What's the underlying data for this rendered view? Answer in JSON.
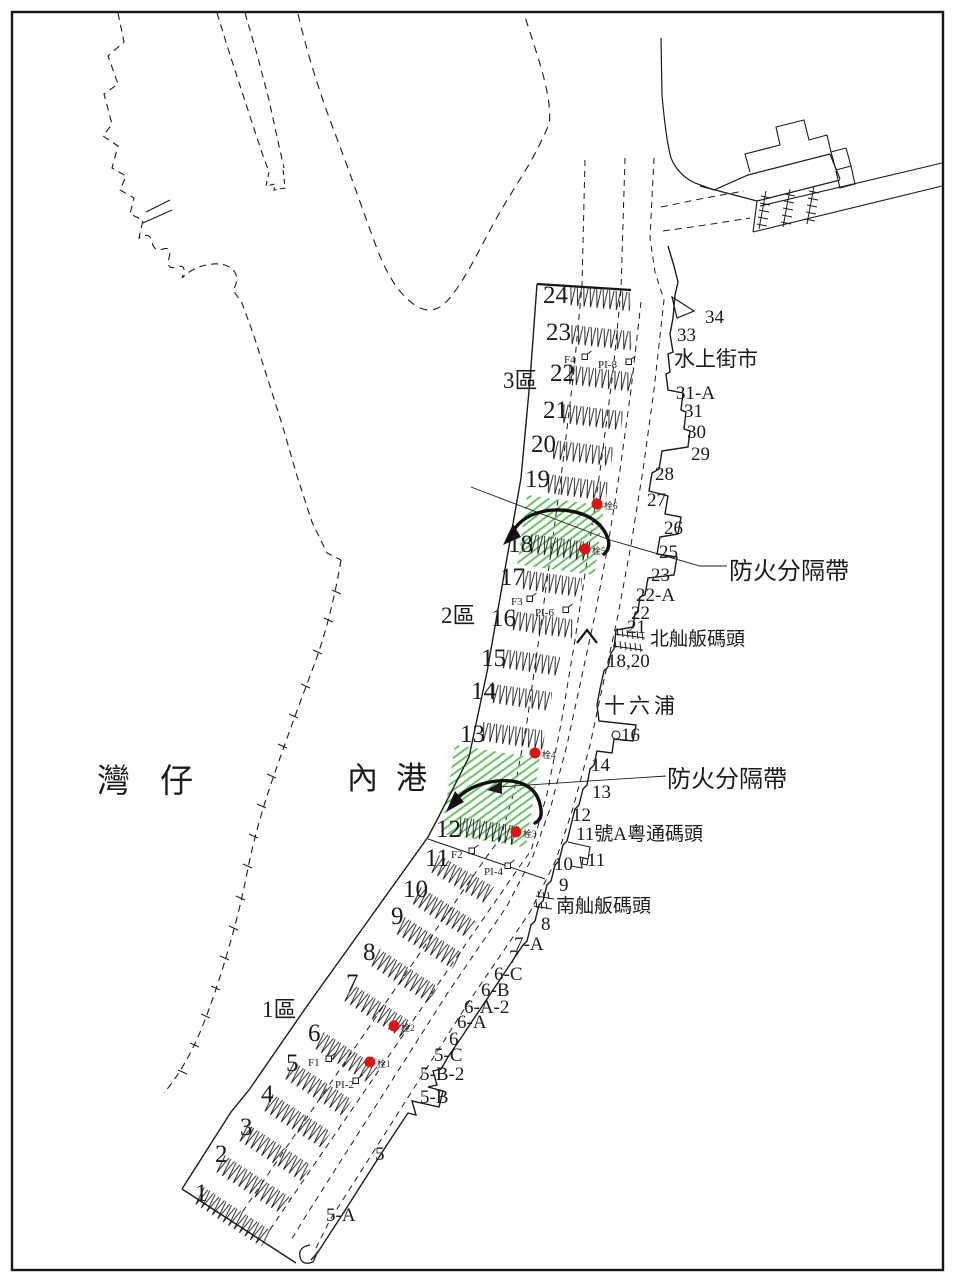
{
  "colors": {
    "ink": "#1c1c1c",
    "green_hatch": "#5cbf5c",
    "red_dot": "#dd1414",
    "red_text": "#e8504a"
  },
  "map": {
    "district_labels": [
      {
        "text": "灣仔",
        "x": 97,
        "y": 792,
        "size": 33,
        "ls": 30
      },
      {
        "text": "內港",
        "x": 347,
        "y": 789,
        "size": 31,
        "ls": 18
      }
    ],
    "zone_labels": [
      {
        "text": "3區",
        "x": 503,
        "y": 388
      },
      {
        "text": "2區",
        "x": 441,
        "y": 623
      },
      {
        "text": "1區",
        "x": 262,
        "y": 1017
      }
    ],
    "firebreak_labels": [
      {
        "text": "防火分隔帶",
        "x": 729,
        "y": 579
      },
      {
        "text": "防火分隔帶",
        "x": 667,
        "y": 787
      }
    ],
    "shore_place_labels": [
      {
        "text": "水上街市",
        "x": 674,
        "y": 366,
        "size": 21
      },
      {
        "text": "北舢舨碼頭",
        "x": 650,
        "y": 645,
        "size": 19
      },
      {
        "text": "十六浦",
        "x": 604,
        "y": 713,
        "size": 21,
        "ls": 4
      },
      {
        "text": "11號A粵通碼頭",
        "x": 576,
        "y": 840,
        "size": 19
      },
      {
        "text": "南舢舨碼頭",
        "x": 556,
        "y": 912,
        "size": 19
      }
    ],
    "berth_labels": [
      {
        "text": "34",
        "x": 705,
        "y": 323
      },
      {
        "text": "33",
        "x": 677,
        "y": 341
      },
      {
        "text": "31-A",
        "x": 676,
        "y": 399
      },
      {
        "text": "31",
        "x": 684,
        "y": 417
      },
      {
        "text": "30",
        "x": 687,
        "y": 438
      },
      {
        "text": "29",
        "x": 691,
        "y": 460
      },
      {
        "text": "28",
        "x": 655,
        "y": 480
      },
      {
        "text": "27",
        "x": 647,
        "y": 506
      },
      {
        "text": "26",
        "x": 664,
        "y": 534
      },
      {
        "text": "25",
        "x": 659,
        "y": 558
      },
      {
        "text": "23",
        "x": 651,
        "y": 581
      },
      {
        "text": "22-A",
        "x": 636,
        "y": 601
      },
      {
        "text": "22",
        "x": 631,
        "y": 619
      },
      {
        "text": "21",
        "x": 627,
        "y": 633
      },
      {
        "text": "18,20",
        "x": 607,
        "y": 667
      },
      {
        "text": "16",
        "x": 621,
        "y": 741
      },
      {
        "text": "14",
        "x": 591,
        "y": 771
      },
      {
        "text": "13",
        "x": 592,
        "y": 798
      },
      {
        "text": "12",
        "x": 572,
        "y": 821
      },
      {
        "text": "11",
        "x": 587,
        "y": 866
      },
      {
        "text": "10",
        "x": 554,
        "y": 870
      },
      {
        "text": "9",
        "x": 559,
        "y": 891
      },
      {
        "text": "8",
        "x": 541,
        "y": 930
      },
      {
        "text": "7-A",
        "x": 514,
        "y": 950
      },
      {
        "text": "7",
        "x": 509,
        "y": 963
      },
      {
        "text": "6-C",
        "x": 494,
        "y": 980
      },
      {
        "text": "6-B",
        "x": 481,
        "y": 996
      },
      {
        "text": "6-A-2",
        "x": 464,
        "y": 1013
      },
      {
        "text": "6-A",
        "x": 457,
        "y": 1028
      },
      {
        "text": "6",
        "x": 449,
        "y": 1045
      },
      {
        "text": "5-C",
        "x": 434,
        "y": 1061
      },
      {
        "text": "5-B-2",
        "x": 420,
        "y": 1080
      },
      {
        "text": "5-B",
        "x": 420,
        "y": 1103
      },
      {
        "text": "5",
        "x": 375,
        "y": 1160
      },
      {
        "text": "5-A",
        "x": 326,
        "y": 1221
      }
    ],
    "mooring_rows": [
      {
        "no": "24",
        "label_x": 543,
        "label_y": 303,
        "x": 570,
        "y": 285,
        "len": 62,
        "angle": 6
      },
      {
        "no": "23",
        "label_x": 546,
        "label_y": 340,
        "x": 571,
        "y": 324,
        "len": 62,
        "angle": 6
      },
      {
        "no": "22",
        "label_x": 550,
        "label_y": 381,
        "x": 569,
        "y": 364,
        "len": 65,
        "angle": 7
      },
      {
        "no": "21",
        "label_x": 543,
        "label_y": 418,
        "x": 563,
        "y": 403,
        "len": 61,
        "angle": 7
      },
      {
        "no": "20",
        "label_x": 531,
        "label_y": 452,
        "x": 553,
        "y": 439,
        "len": 61,
        "angle": 7
      },
      {
        "no": "19",
        "label_x": 525,
        "label_y": 487,
        "x": 548,
        "y": 473,
        "len": 61,
        "angle": 8
      },
      {
        "no": "18",
        "label_x": 508,
        "label_y": 552,
        "x": 531,
        "y": 533,
        "len": 59,
        "angle": 8
      },
      {
        "no": "17",
        "label_x": 500,
        "label_y": 585,
        "x": 523,
        "y": 569,
        "len": 60,
        "angle": 8
      },
      {
        "no": "16",
        "label_x": 491,
        "label_y": 626,
        "x": 513,
        "y": 610,
        "len": 62,
        "angle": 8
      },
      {
        "no": "15",
        "label_x": 481,
        "label_y": 666,
        "x": 503,
        "y": 648,
        "len": 58,
        "angle": 8
      },
      {
        "no": "14",
        "label_x": 471,
        "label_y": 699,
        "x": 493,
        "y": 683,
        "len": 60,
        "angle": 8
      },
      {
        "no": "13",
        "label_x": 460,
        "label_y": 742,
        "x": 483,
        "y": 721,
        "len": 63,
        "angle": 8
      },
      {
        "no": "12",
        "label_x": 436,
        "label_y": 837,
        "x": 460,
        "y": 816,
        "len": 60,
        "angle": 9
      },
      {
        "no": "11",
        "label_x": 425,
        "label_y": 866,
        "x": 439,
        "y": 854,
        "len": 64,
        "angle": 30
      },
      {
        "no": "10",
        "label_x": 403,
        "label_y": 897,
        "x": 421,
        "y": 886,
        "len": 66,
        "angle": 32
      },
      {
        "no": "9",
        "label_x": 391,
        "label_y": 924,
        "x": 405,
        "y": 916,
        "len": 68,
        "angle": 32
      },
      {
        "no": "8",
        "label_x": 363,
        "label_y": 960,
        "x": 380,
        "y": 948,
        "len": 70,
        "angle": 33
      },
      {
        "no": "7",
        "label_x": 346,
        "label_y": 991,
        "x": 353,
        "y": 983,
        "len": 70,
        "angle": 33
      },
      {
        "no": "6",
        "label_x": 308,
        "label_y": 1041,
        "x": 324,
        "y": 1031,
        "len": 66,
        "angle": 33
      },
      {
        "no": "5",
        "label_x": 286,
        "label_y": 1071,
        "x": 294,
        "y": 1061,
        "len": 70,
        "angle": 33
      },
      {
        "no": "4",
        "label_x": 261,
        "label_y": 1102,
        "x": 273,
        "y": 1093,
        "len": 70,
        "angle": 33
      },
      {
        "no": "3",
        "label_x": 240,
        "label_y": 1135,
        "x": 248,
        "y": 1123,
        "len": 76,
        "angle": 33
      },
      {
        "no": "2",
        "label_x": 215,
        "label_y": 1162,
        "x": 225,
        "y": 1154,
        "len": 79,
        "angle": 33
      },
      {
        "no": "1",
        "label_x": 195,
        "label_y": 1201,
        "x": 204,
        "y": 1186,
        "len": 81,
        "angle": 33
      }
    ],
    "hydrants": [
      {
        "id": "栓6",
        "x": 597,
        "y": 504
      },
      {
        "id": "栓5",
        "x": 585,
        "y": 549
      },
      {
        "id": "栓4",
        "x": 535,
        "y": 753
      },
      {
        "id": "栓3",
        "x": 516,
        "y": 832
      },
      {
        "id": "栓2",
        "x": 394,
        "y": 1026
      },
      {
        "id": "栓1",
        "x": 370,
        "y": 1062
      }
    ],
    "facility_labels": [
      {
        "id": "F4",
        "x": 564,
        "y": 363,
        "sym_x": 582,
        "sym_y": 354
      },
      {
        "id": "PI-8",
        "x": 598,
        "y": 368,
        "sym_x": 626,
        "sym_y": 359
      },
      {
        "id": "F3",
        "x": 511,
        "y": 605,
        "sym_x": 527,
        "sym_y": 596
      },
      {
        "id": "PI-6",
        "x": 535,
        "y": 616,
        "sym_x": 563,
        "sym_y": 607
      },
      {
        "id": "F2",
        "x": 451,
        "y": 858,
        "sym_x": 469,
        "sym_y": 848
      },
      {
        "id": "PI-4",
        "x": 484,
        "y": 875,
        "sym_x": 505,
        "sym_y": 863
      },
      {
        "id": "F1",
        "x": 308,
        "y": 1066,
        "sym_x": 326,
        "sym_y": 1056
      },
      {
        "id": "PI-2",
        "x": 335,
        "y": 1088,
        "sym_x": 353,
        "sym_y": 1078
      }
    ]
  }
}
